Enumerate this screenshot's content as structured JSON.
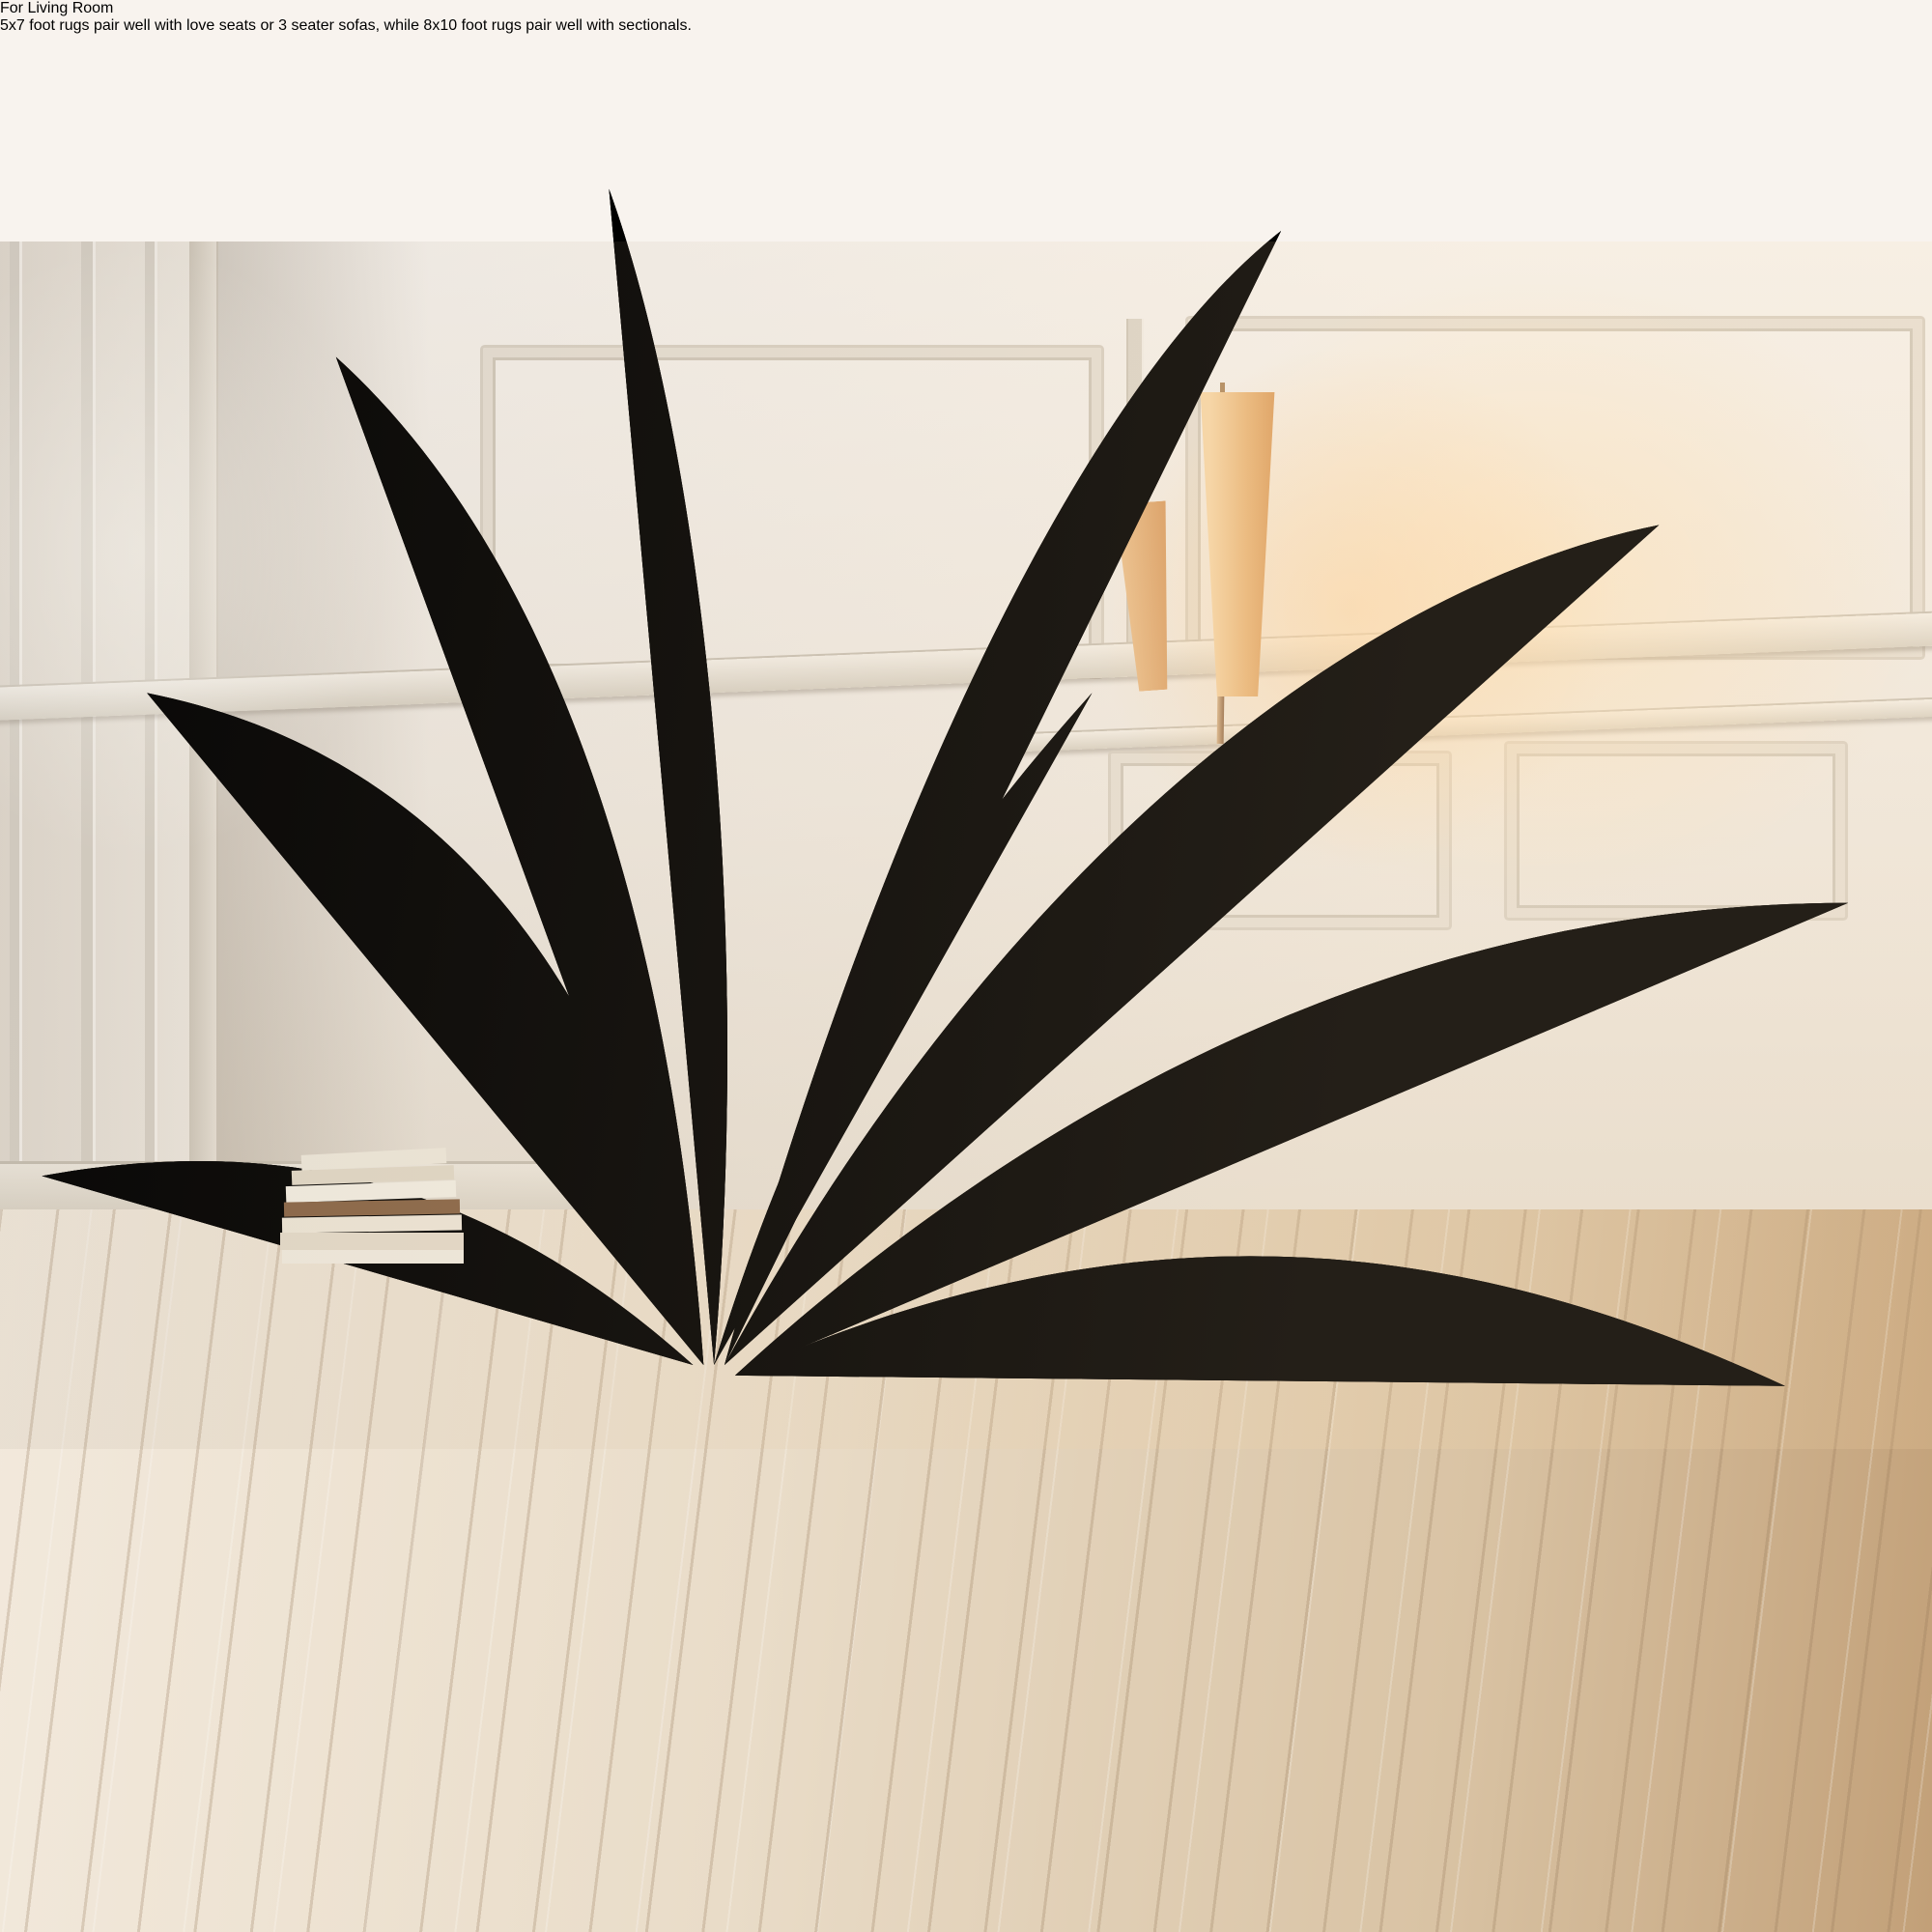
{
  "header": {
    "title": "For Living Room",
    "description": "5x7 foot rugs pair well with love seats or 3 seater sofas, while 8x10 foot rugs pair well with sectionals."
  },
  "size_diagrams": {
    "items": [
      {
        "label": "5x7"
      },
      {
        "label": "8x10"
      }
    ]
  },
  "colors": {
    "background": "#f8f3ee",
    "accent_maroon": "#5e2a23",
    "body_text": "#643129",
    "diagram_rug_pink": "#f2d3c3",
    "diagram_furniture_cream": "#f8e9de",
    "diagram_accent_yellow": "#f7dc8a",
    "diagram_outline": "#2e2722",
    "size_label_brown": "#6e5f4c",
    "rug_green": "#143020",
    "rug_gold": "#d7ab56",
    "rug_ivory": "#f4efdb",
    "pot_terracotta": "#c07a4f"
  }
}
